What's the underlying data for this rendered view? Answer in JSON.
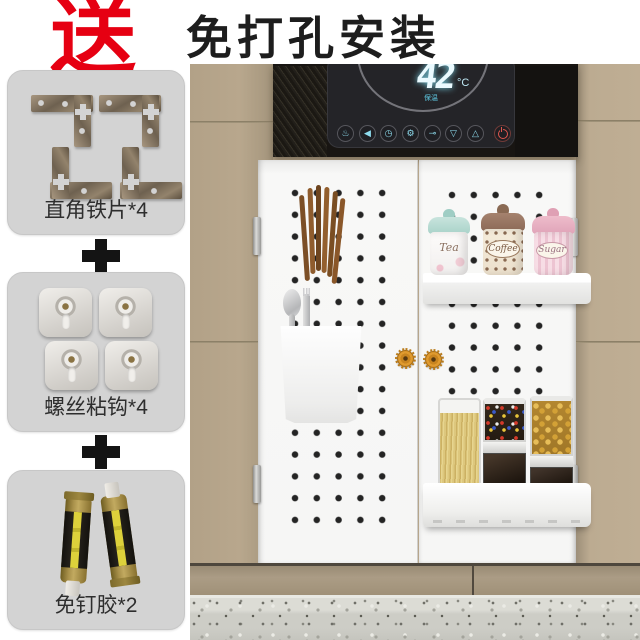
{
  "header": {
    "gift_label": "送",
    "title": "免打孔安装"
  },
  "bundle": {
    "plus": "+",
    "items": [
      {
        "name": "corner-iron-plates",
        "label": "直角铁片*4"
      },
      {
        "name": "screw-adhesive-hooks",
        "label": "螺丝粘钩*4"
      },
      {
        "name": "nail-free-glue",
        "label": "免钉胶*2"
      }
    ]
  },
  "appliance": {
    "temperature": "42",
    "unit": "°C",
    "status": "保温",
    "display_color": "#a7e6f4",
    "power_color": "#e0574e",
    "buttons": [
      {
        "name": "shower-icon",
        "glyph": "♨"
      },
      {
        "name": "speaker-icon",
        "glyph": "◀"
      },
      {
        "name": "clock-icon",
        "glyph": "◷"
      },
      {
        "name": "gear-icon",
        "glyph": "⚙"
      },
      {
        "name": "key-icon",
        "glyph": "⊸"
      },
      {
        "name": "arrow-down-icon",
        "glyph": "▽"
      },
      {
        "name": "arrow-up-icon",
        "glyph": "△"
      }
    ]
  },
  "scene": {
    "cabinet_color": "#b7a68c",
    "accent_red": "#e60012",
    "jars": [
      {
        "label": "Tea"
      },
      {
        "label": "Coffee"
      },
      {
        "label": "Sugar"
      }
    ]
  }
}
